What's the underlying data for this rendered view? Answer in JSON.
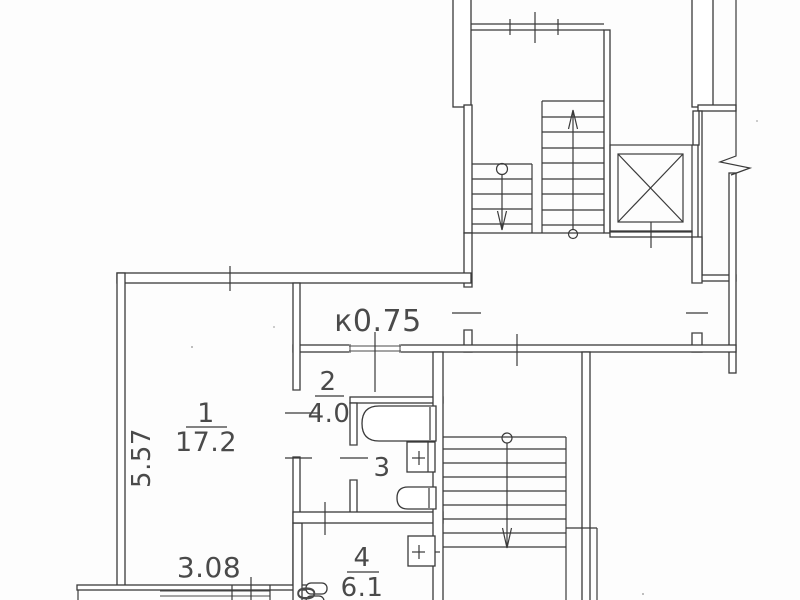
{
  "plan": {
    "rooms": [
      {
        "number": "1",
        "area": "17.2"
      },
      {
        "number": "2",
        "area": "4.0"
      },
      {
        "number": "3"
      },
      {
        "number": "4",
        "area": "6.1"
      }
    ],
    "dimensions": {
      "room1_width": "3.08",
      "room1_height": "5.57",
      "door_width_note": "к0.75",
      "edge_dimension": "60"
    }
  }
}
